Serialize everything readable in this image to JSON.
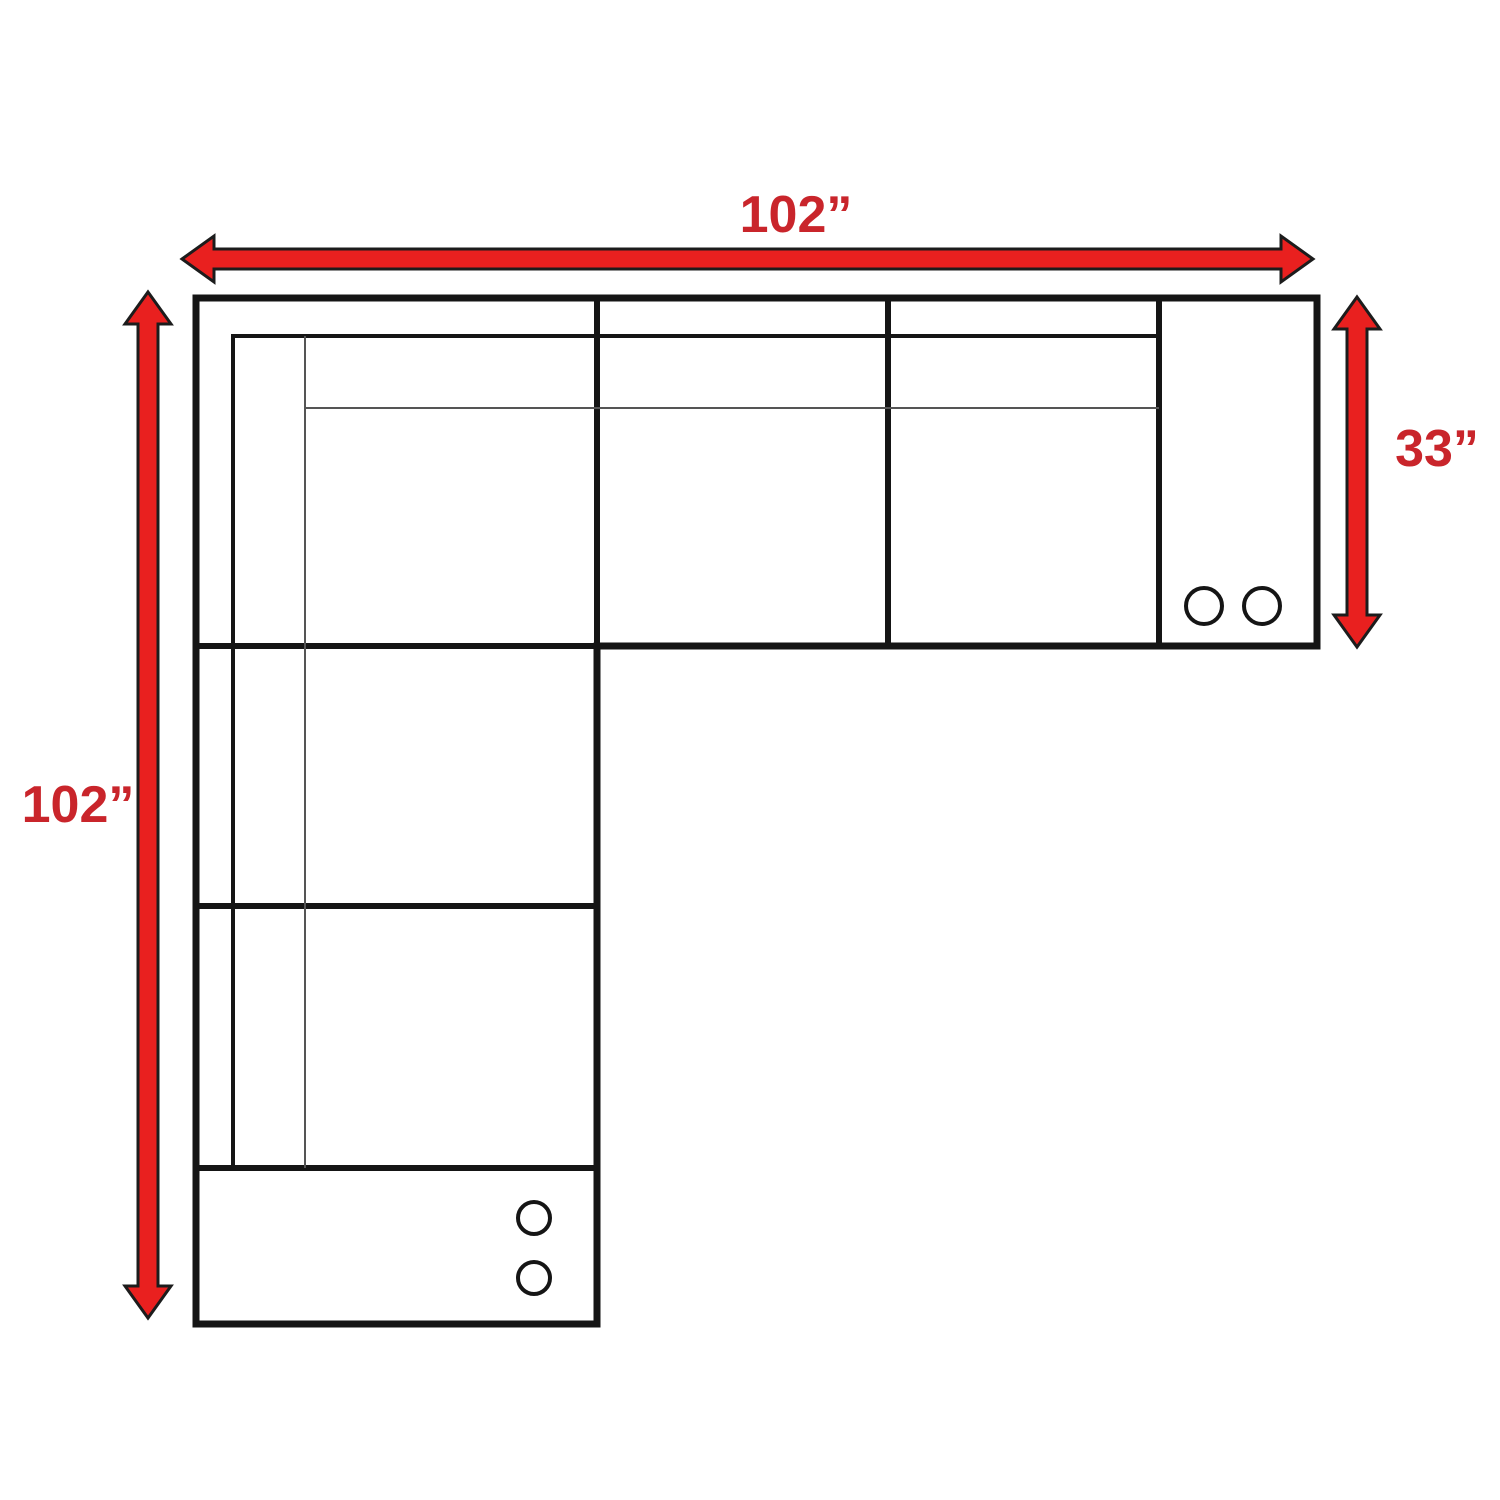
{
  "diagram": {
    "type": "sectional-sofa-floorplan",
    "dimension_labels": {
      "top_width": "102”",
      "left_length": "102”",
      "right_depth": "33”"
    },
    "cupholder_counts": {
      "right_arm_section": 2,
      "bottom_arm_section": 2
    }
  },
  "icons": {
    "dimension_arrow": "double-headed-arrow",
    "cupholder": "circle-outline"
  },
  "colors": {
    "background": "#ffffff",
    "arrow_fill": "#e9201f",
    "arrow_outline": "#1c1c1c",
    "label_color": "#c9252b",
    "line_color": "#151515",
    "thin_line_color": "#555555"
  }
}
